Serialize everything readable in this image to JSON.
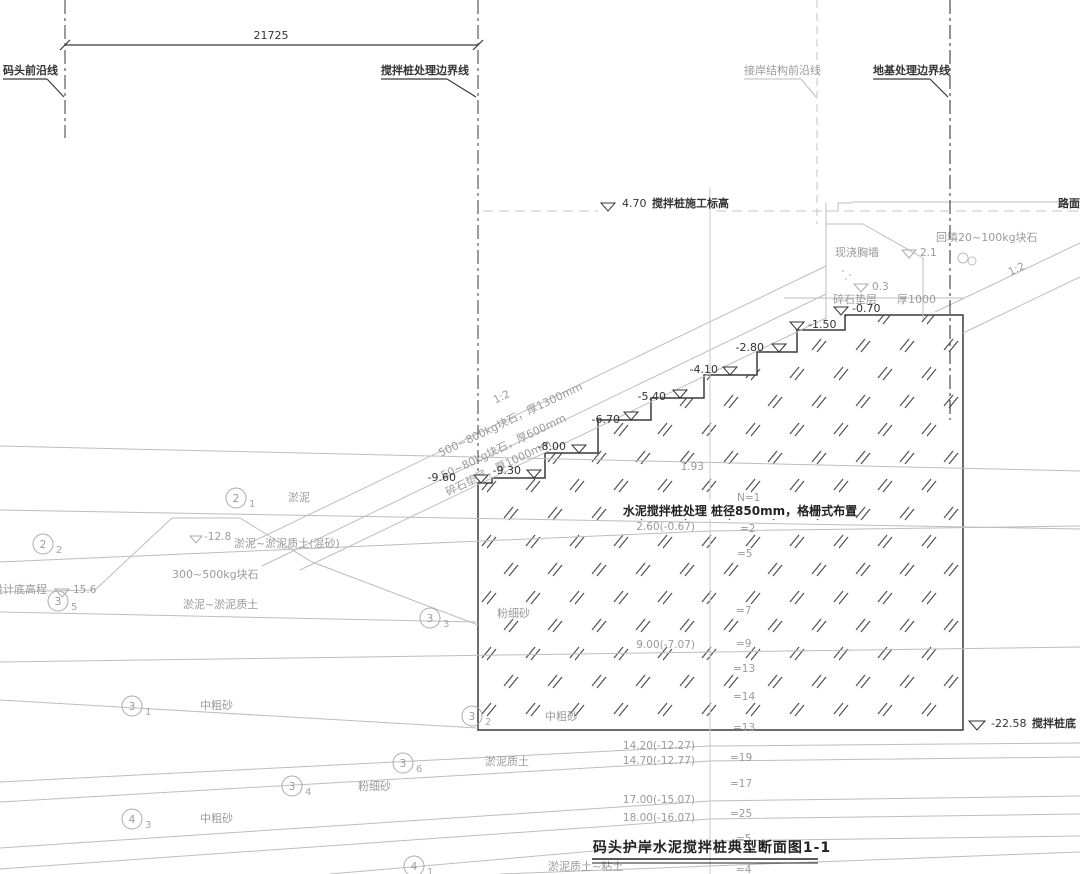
{
  "drawing": {
    "title": "码头护岸水泥搅拌桩典型断面图1-1",
    "dimension": "21725",
    "boundaries": {
      "wharf_front": "码头前沿线",
      "mixing_pile": "搅拌桩处理边界线",
      "shore_structure": "接岸结构前沿线",
      "foundation": "地基处理边界线"
    },
    "construction_level": {
      "value": "4.70",
      "label": "搅拌桩施工标高"
    },
    "road": "路面",
    "wall": "现浇胸墙",
    "backfill": "回填20~100kg块石",
    "wall_levels": {
      "crest": "2.1",
      "toe": "0.3"
    },
    "bedding": {
      "left": "碎石垫层",
      "right": "厚1000"
    },
    "slopes": {
      "ratio_left": "1:2",
      "ratio_right": "1:2",
      "armor1": "500~800kg块石，厚1300mm",
      "armor2": "50~80kg块石，厚600mm",
      "bedding_rot": "碎石垫层，厚1000mm"
    },
    "steps": [
      "-0.70",
      "-1.50",
      "-2.80",
      "-4.10",
      "-5.40",
      "-6.70",
      "-8.00",
      "-9.30",
      "-9.60"
    ],
    "pile_spec": "水泥搅拌桩处理  桩径850mm，格栅式布置",
    "pile_bottom": {
      "value": "-22.58",
      "label": "搅拌桩底"
    },
    "datum_offset": "1.93",
    "counts": [
      "N=1",
      "=2",
      "=5",
      "=7",
      "=9",
      "=13",
      "=14",
      "=13",
      "=19",
      "=17",
      "=25",
      "=5",
      "=4"
    ],
    "depths": [
      "2.60(-0.67)",
      "9.00(-7.07)",
      "14.20(-12.27)",
      "14.70(-12.77)",
      "17.00(-15.07)",
      "18.00(-16.07)"
    ],
    "design_bottom": {
      "label": "设计底高程",
      "value": "15.6"
    },
    "mud_level": {
      "value": "-12.8",
      "label": "淤泥~淤泥质土(混砂)"
    },
    "prism": "300~500kg块石",
    "soils": {
      "silt": "淤泥",
      "silt_silty": "淤泥~淤泥质土",
      "sand_mc1": "中粗砂",
      "sand_mc2": "中粗砂",
      "sand_mc3": "中粗砂",
      "sand_f1": "粉细砂",
      "sand_f2": "粉细砂",
      "silty": "淤泥质土",
      "silty_clay": "淤泥质土~粘土"
    },
    "layers": [
      {
        "n": "2",
        "s": "1"
      },
      {
        "n": "2",
        "s": "2"
      },
      {
        "n": "3",
        "s": "5"
      },
      {
        "n": "3",
        "s": "3"
      },
      {
        "n": "3",
        "s": "1"
      },
      {
        "n": "3",
        "s": "2"
      },
      {
        "n": "3",
        "s": "6"
      },
      {
        "n": "3",
        "s": "4"
      },
      {
        "n": "4",
        "s": "3"
      },
      {
        "n": "4",
        "s": "1"
      }
    ]
  }
}
